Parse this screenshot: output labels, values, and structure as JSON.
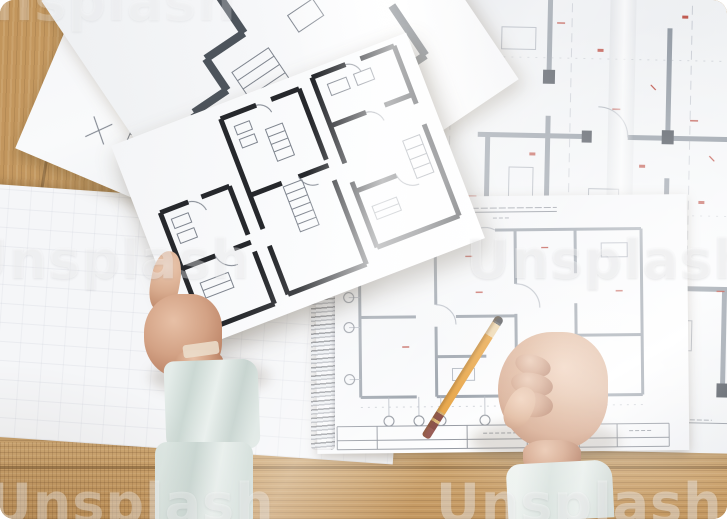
{
  "watermark": {
    "text": "Unsplash"
  },
  "palette": {
    "wood": "#c79c63",
    "paper_white": "#f5f6f8",
    "blueprint_wall_gray": "#8f97a1",
    "plan_wall_black": "#26282c",
    "annotation_red": "#b5392e",
    "sleeve_left_mint": "#dbe5e1",
    "sleeve_right_white": "#e9efec",
    "pencil_orange": "#e59a2f",
    "skin": "#d3a285"
  }
}
